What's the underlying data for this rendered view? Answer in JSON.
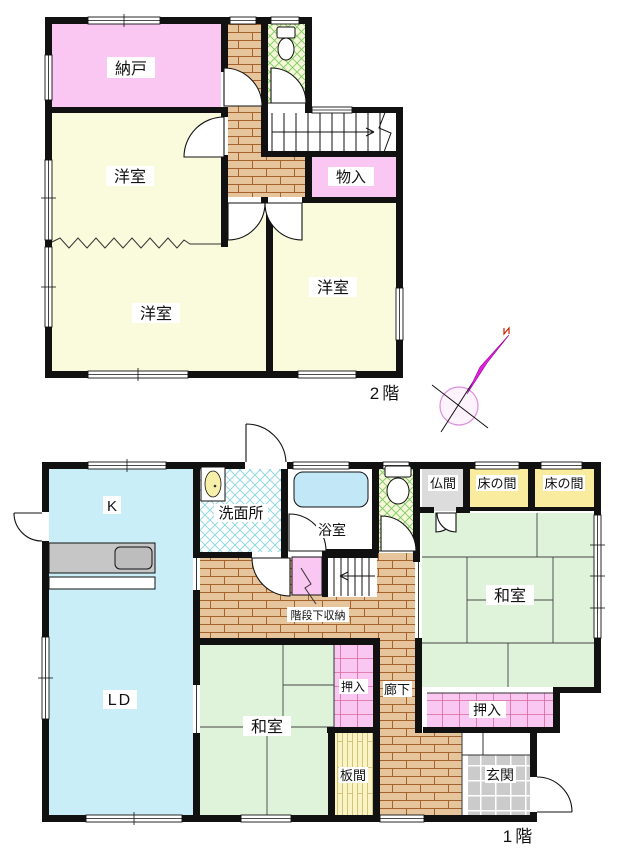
{
  "floor2": {
    "floor_label": "2階",
    "rooms": {
      "nando": "納戸",
      "youshitsu_nw": "洋室",
      "youshitsu_sw": "洋室",
      "youshitsu_se": "洋室",
      "monoire": "物入"
    }
  },
  "floor1": {
    "floor_label": "1階",
    "rooms": {
      "kitchen": "K",
      "living_dining": "LD",
      "senmenjo": "洗面所",
      "yokushitsu": "浴室",
      "butsuma": "仏間",
      "tokonoma_left": "床の間",
      "tokonoma_right": "床の間",
      "washitsu_main": "和室",
      "washitsu_west": "和室",
      "oshiire_small": "押入",
      "oshiire_main": "押入",
      "rouka": "廊下",
      "itama": "板間",
      "genkan": "玄関",
      "kaidan_shita": "階段下収納"
    }
  },
  "compass": {
    "north_mark": "N"
  },
  "colors": {
    "wall": "#111111",
    "room_pink": "#FAC6F2",
    "room_cream": "#FAFADC",
    "room_blue": "#C9EEF8",
    "tatami_green": "#DFF3DA",
    "wood_floor": "#E6C59C",
    "wood_line": "#A5622D",
    "tokonoma_yellow": "#FAEC9E",
    "butsuma_gray": "#DCDCDC",
    "itama_yellow": "#FAF3C4",
    "genkan_tile_gray": "#CBCBCB",
    "toilet_bg": "#F5F7D8",
    "toilet_hatch": "#7CCB62",
    "senmenjo_hatch": "#86D6DE",
    "oshiire_grid": "#D9699F",
    "compass_needle": "#E020E0"
  }
}
